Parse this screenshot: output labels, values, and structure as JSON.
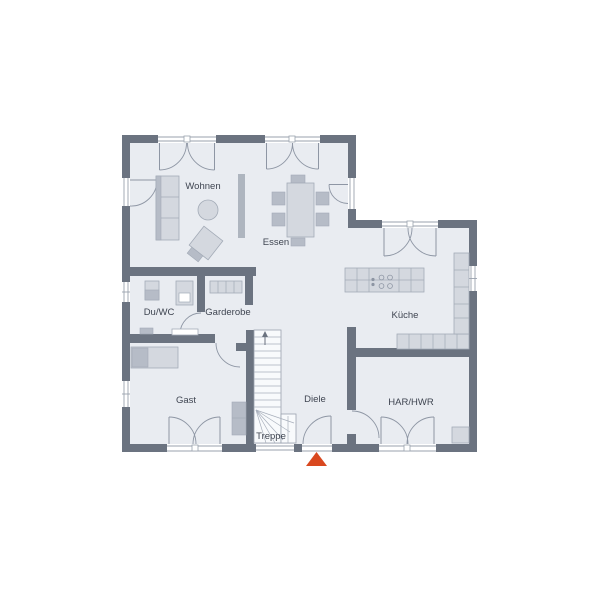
{
  "plan": {
    "type": "ground-floor architectural plan",
    "rooms": {
      "wohnen": "Wohnen",
      "essen": "Essen",
      "kueche": "Küche",
      "duwc": "Du/WC",
      "garderobe": "Garderobe",
      "gast": "Gast",
      "diele": "Diele",
      "treppe": "Treppe",
      "har": "HAR/HWR"
    },
    "colors": {
      "wall": "#6b7380",
      "floor": "#e9ecf1",
      "furniture_light": "#d4d8df",
      "furniture_mid": "#b6bcc7",
      "detail_line": "#8e96a4",
      "entrance_marker": "#d9481f",
      "label_text": "#3f4551"
    },
    "icons": {
      "entrance_marker": "triangle-up",
      "stair_direction": "arrow-up"
    }
  }
}
